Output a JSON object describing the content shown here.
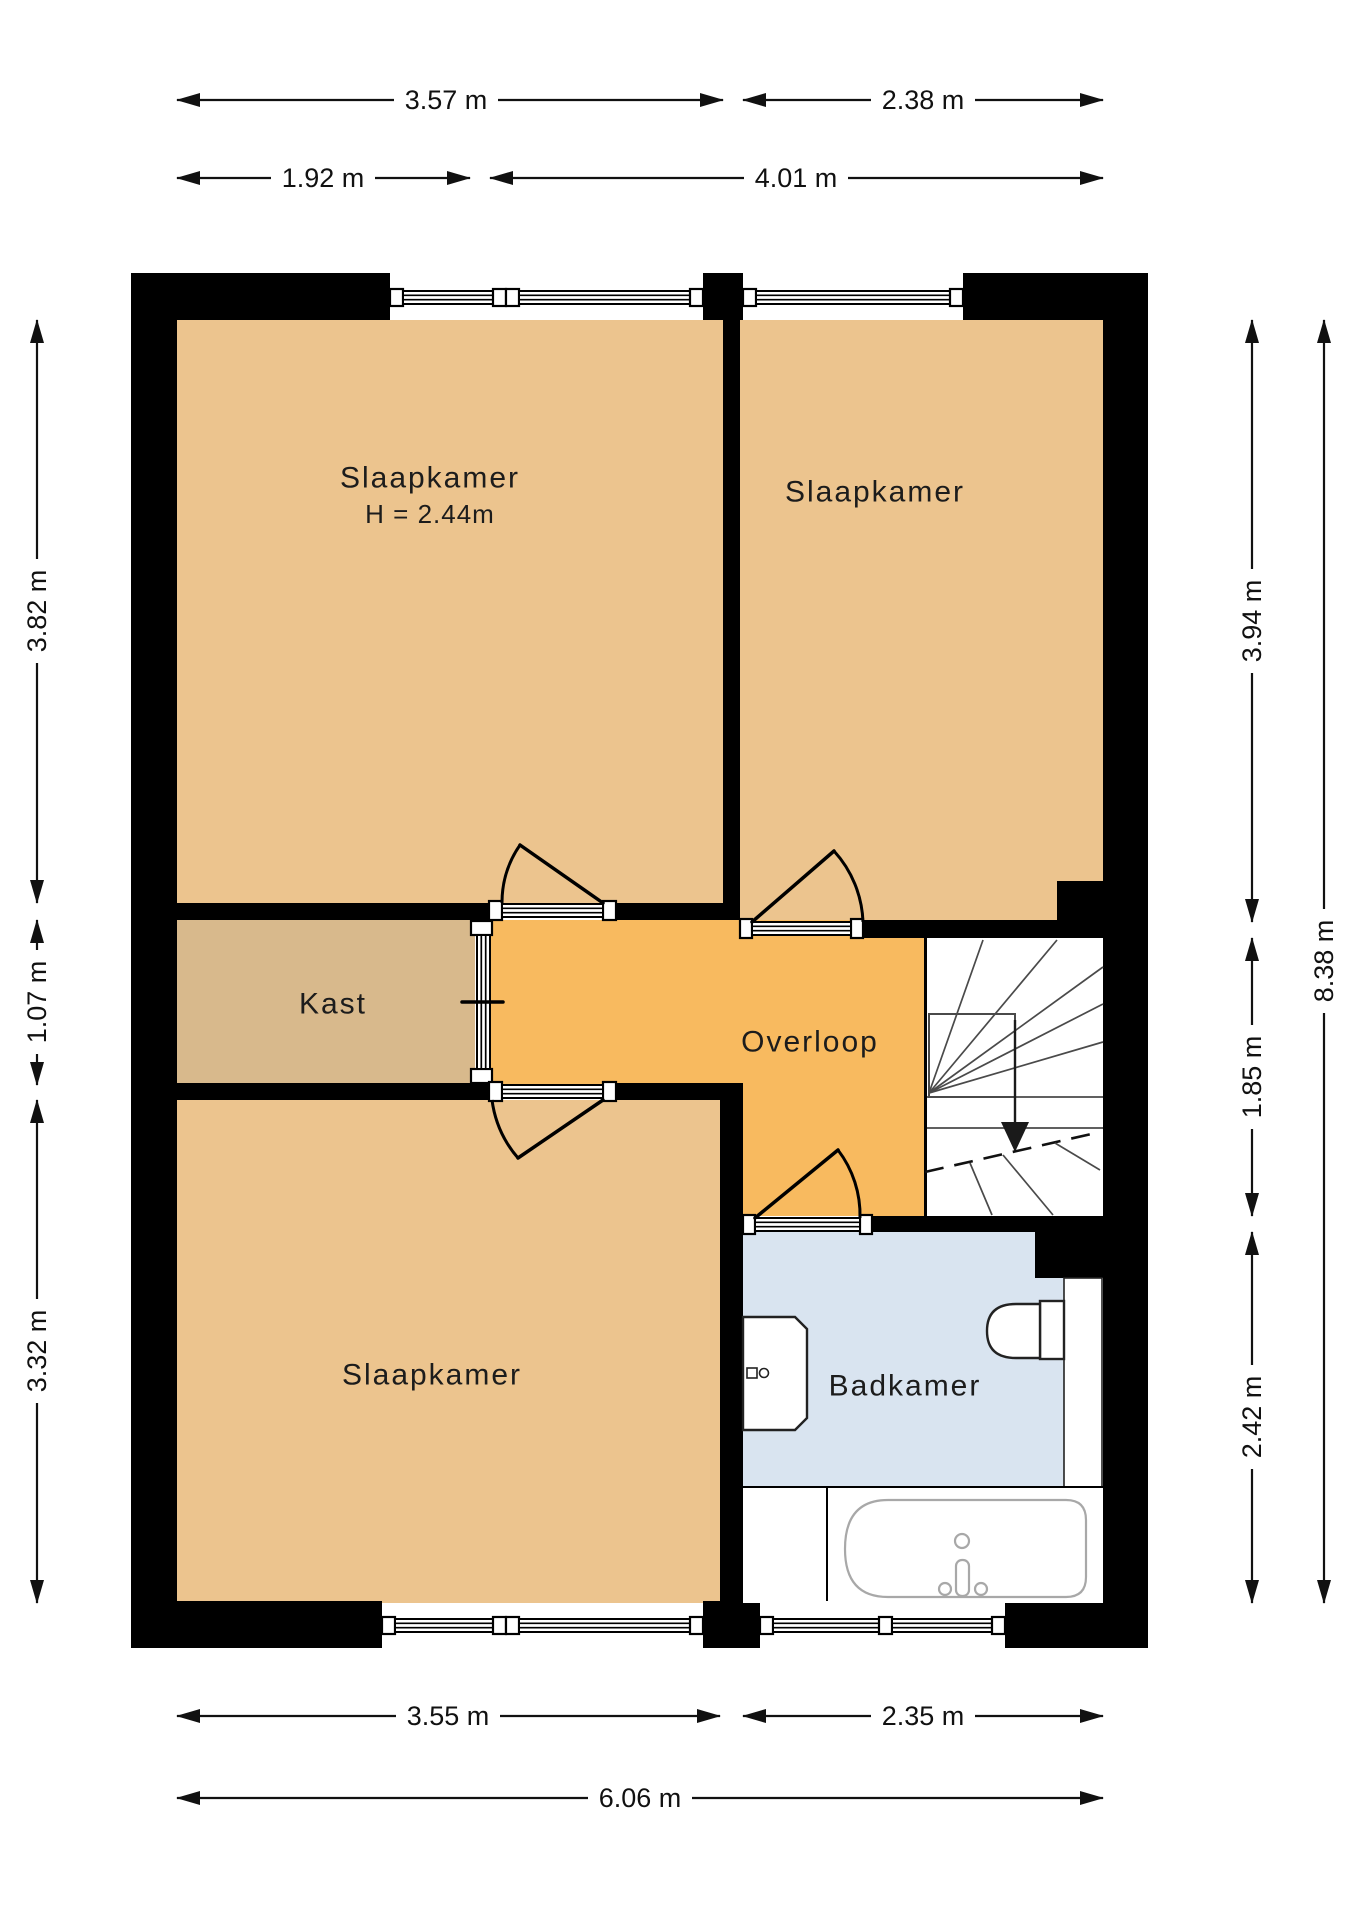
{
  "title": "Floor plan - first floor (verdieping)",
  "rooms": {
    "bedroom_top_left": {
      "label": "Slaapkamer",
      "ceiling_height": "H = 2.44m"
    },
    "bedroom_top_right": {
      "label": "Slaapkamer"
    },
    "closet": {
      "label": "Kast"
    },
    "landing": {
      "label": "Overloop"
    },
    "bedroom_bottom": {
      "label": "Slaapkamer"
    },
    "bathroom": {
      "label": "Badkamer"
    }
  },
  "dimensions": {
    "top_row1_left": "3.57 m",
    "top_row1_right": "2.38 m",
    "top_row2_left": "1.92 m",
    "top_row2_right": "4.01 m",
    "left_top": "3.82 m",
    "left_middle": "1.07 m",
    "left_bottom": "3.32 m",
    "right_top": "3.94 m",
    "right_middle": "1.85 m",
    "right_bottom": "2.42 m",
    "right_total": "8.38 m",
    "bottom_row1_left": "3.55 m",
    "bottom_row1_right": "2.35 m",
    "bottom_total": "6.06 m"
  },
  "colors": {
    "bg": "#ffffff",
    "wall": "#000000",
    "bedroom": "#ecc48e",
    "closet": "#d8b98c",
    "landing": "#f8ba5f",
    "bathroom": "#d9e4f0",
    "stairs": "#ffffff"
  }
}
